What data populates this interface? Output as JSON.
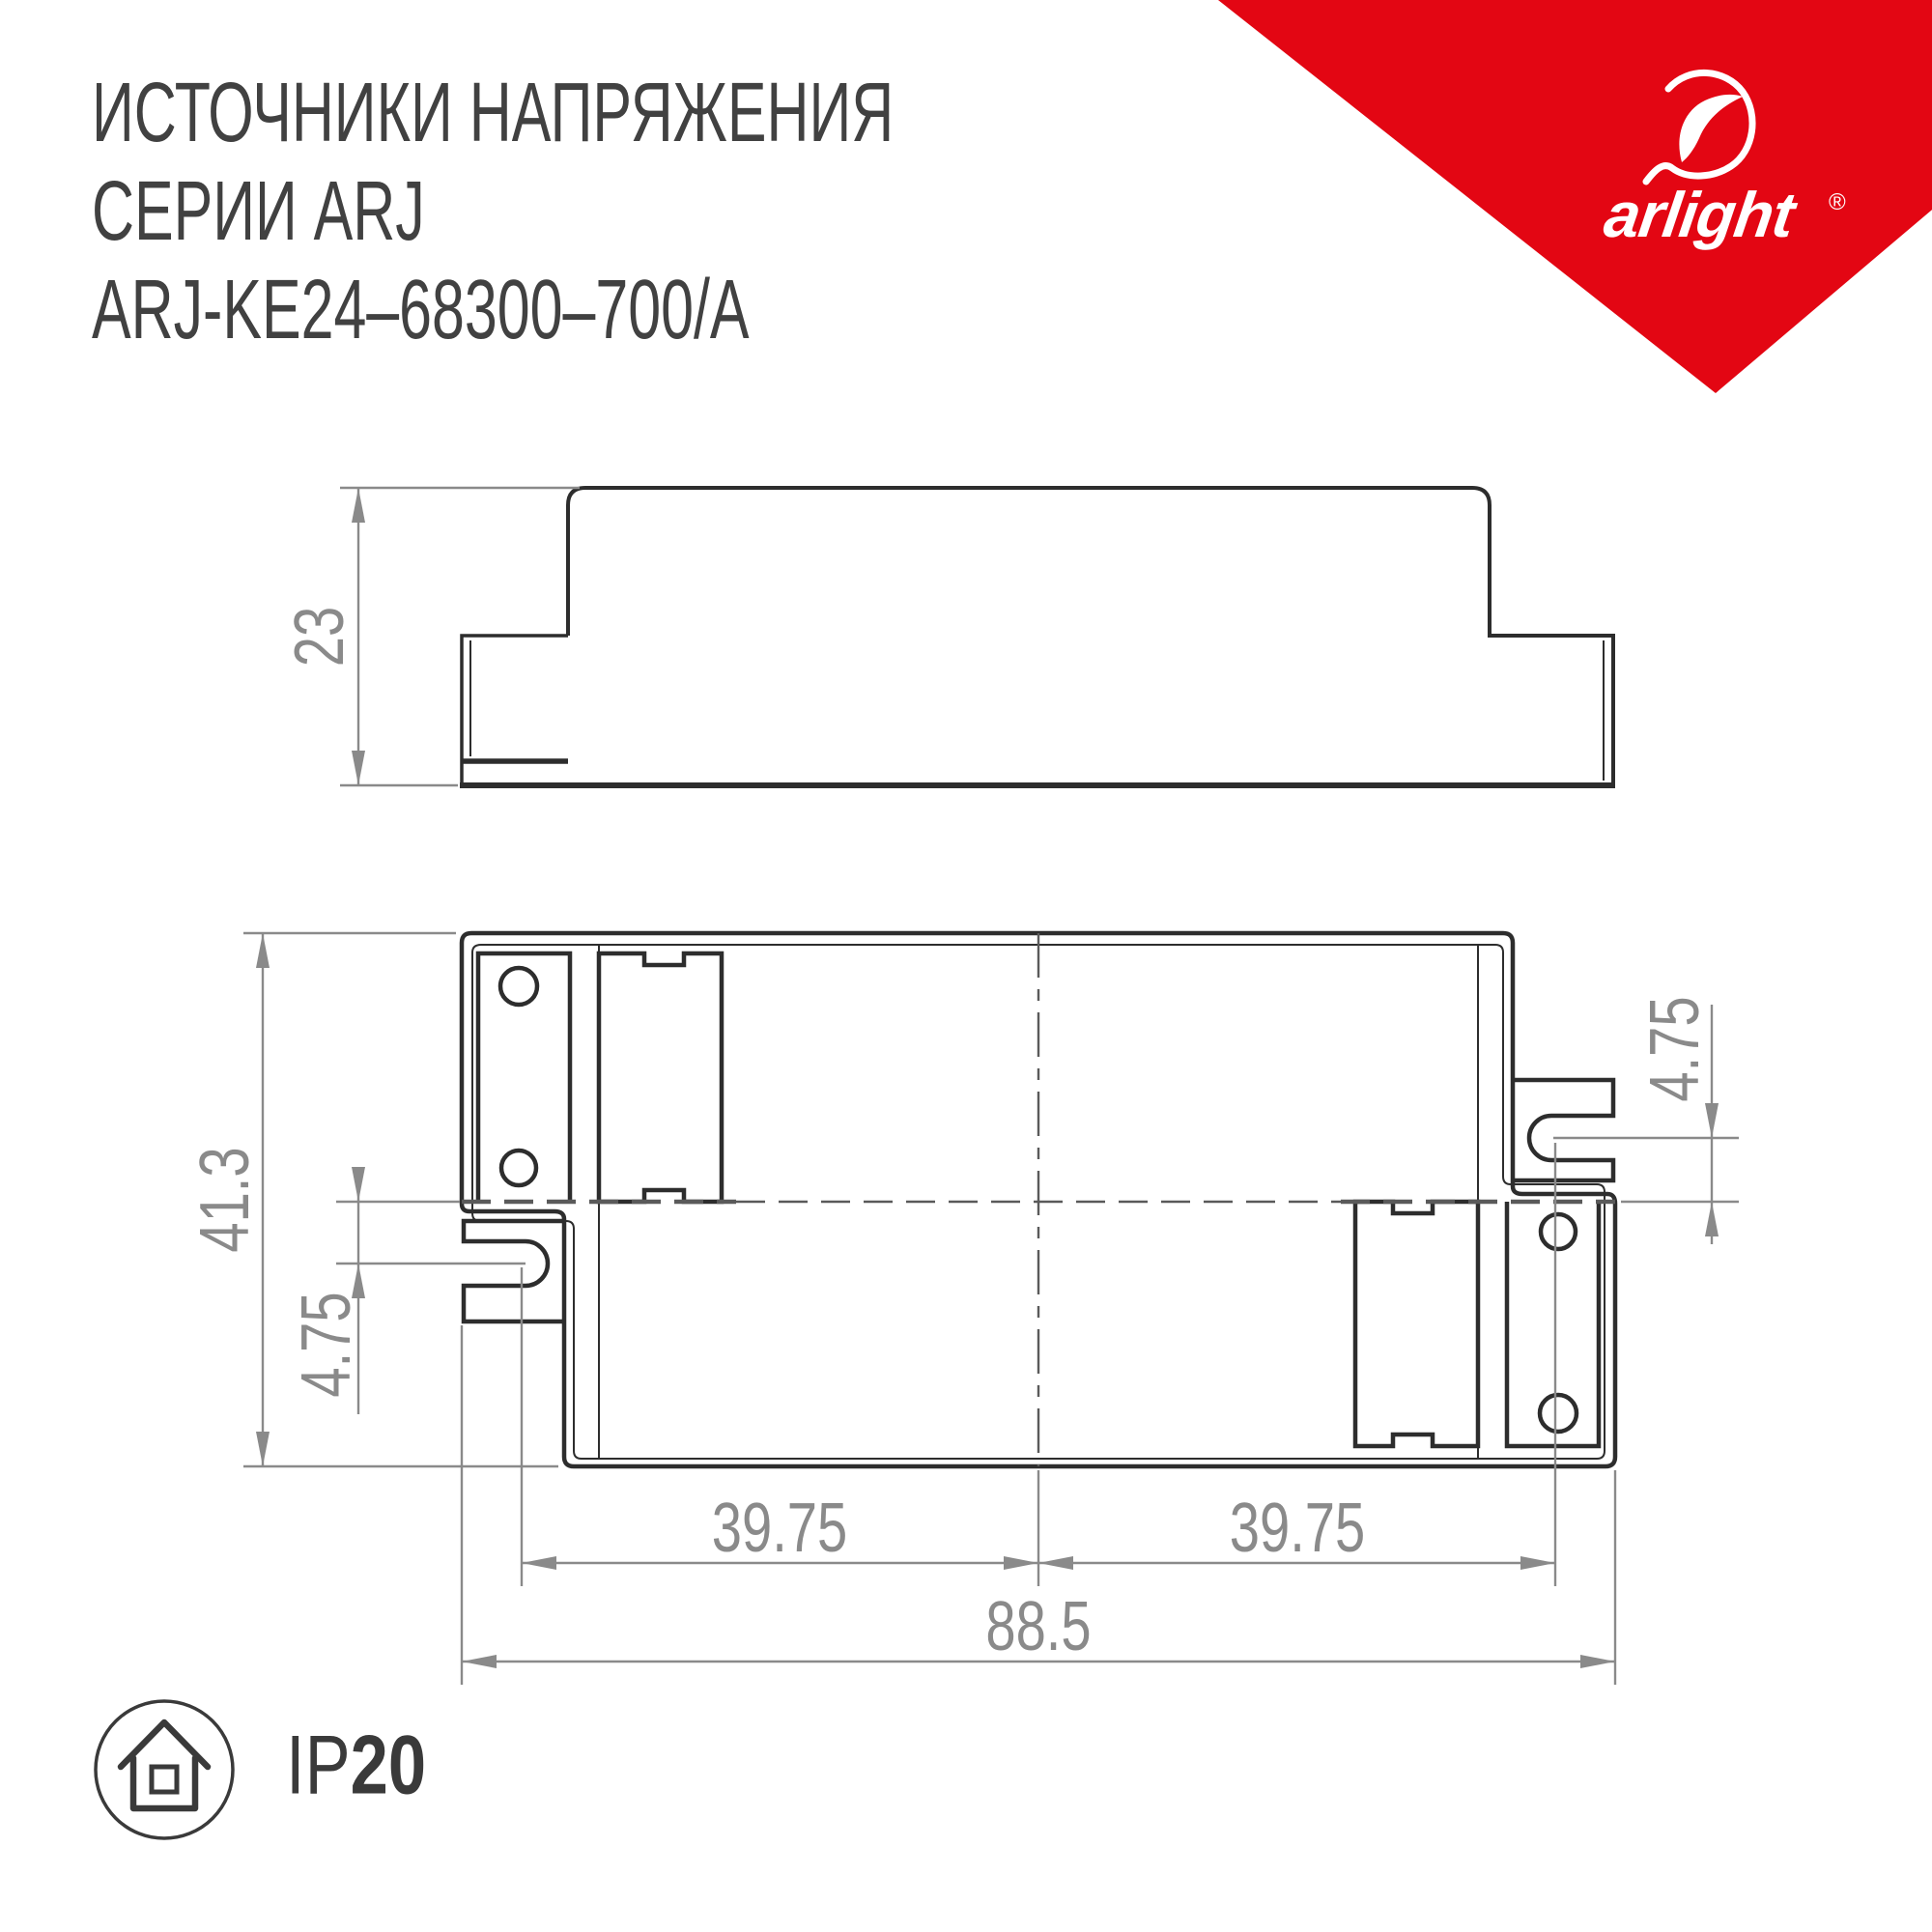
{
  "title": {
    "line1": "ИСТОЧНИКИ НАПРЯЖЕНИЯ",
    "line2": "СЕРИИ ARJ",
    "line3": "ARJ-KE24–68300–700/A"
  },
  "brand": {
    "name": "arlight",
    "registered": "®",
    "red": "#e30613"
  },
  "colors": {
    "drawing_line": "#2d2d2d",
    "dimension_gray": "#8a8a8a",
    "centerline_gray": "#5a5a5a"
  },
  "drawings": {
    "side_view": {
      "height_label": "23"
    },
    "top_view": {
      "height_label": "41.3",
      "slot_left_label": "4.75",
      "slot_right_label": "4.75",
      "width_left_label": "39.75",
      "width_right_label": "39.75",
      "width_total_label": "88.5"
    }
  },
  "footer": {
    "protection_prefix": "IP",
    "protection_value": "20"
  }
}
